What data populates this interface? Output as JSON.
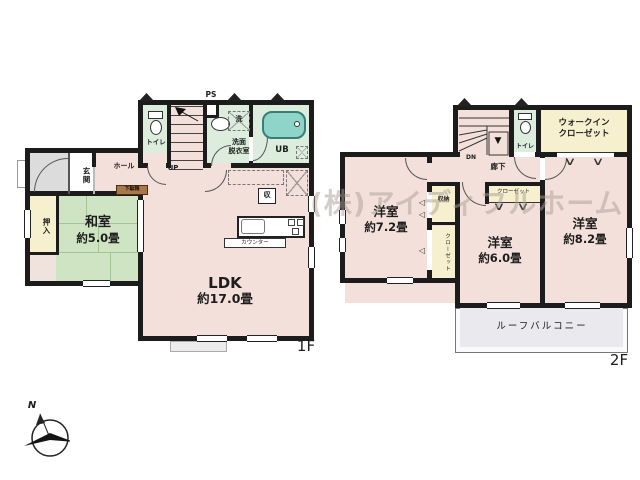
{
  "colors": {
    "wall": "#1c1c1c",
    "room-pink": "#f4e0da",
    "tatami-green": "#cfe4c3",
    "wet-green": "#dcedde",
    "closet-cream": "#f6f0cf",
    "porch-gray": "#dcdcdc",
    "balcony": "#e9e9ee",
    "bath-teal": "#8fd4c8",
    "shoe-brown": "#a9784a",
    "watermark": "rgba(168,158,148,0.5)"
  },
  "watermark": "(株)アイディフルホーム",
  "compass_north": "N",
  "symbols": {
    "fold_v": "∨",
    "fold_left": "◁",
    "down_arrow": "▼"
  },
  "floor1": {
    "label": "1F",
    "toilet": "トイレ",
    "ps": "PS",
    "washroom1": "洗面",
    "washroom2": "脱衣室",
    "bath": "UB",
    "laundry": "洗",
    "stairs": "UP",
    "hall": "ホール",
    "entrance": "玄関",
    "shoe_cabinet": "下駄箱",
    "closet": "押入",
    "washitsu": "和室",
    "washitsu_size": "約5.0畳",
    "ldk": "LDK",
    "ldk_size": "約17.0畳",
    "counter": "カウンター",
    "storage": "収"
  },
  "floor2": {
    "label": "2F",
    "stairs": "DN",
    "toilet": "トイレ",
    "wic1": "ウォークイン",
    "wic2": "クローゼット",
    "corridor": "廊下",
    "bedroom1": "洋室",
    "bedroom1_size": "約7.2畳",
    "storage": "収納",
    "closet1": "クローゼット",
    "closet2": "クローゼット",
    "bedroom2": "洋室",
    "bedroom2_size": "約6.0畳",
    "bedroom3": "洋室",
    "bedroom3_size": "約8.2畳",
    "balcony": "ルーフバルコニー"
  }
}
